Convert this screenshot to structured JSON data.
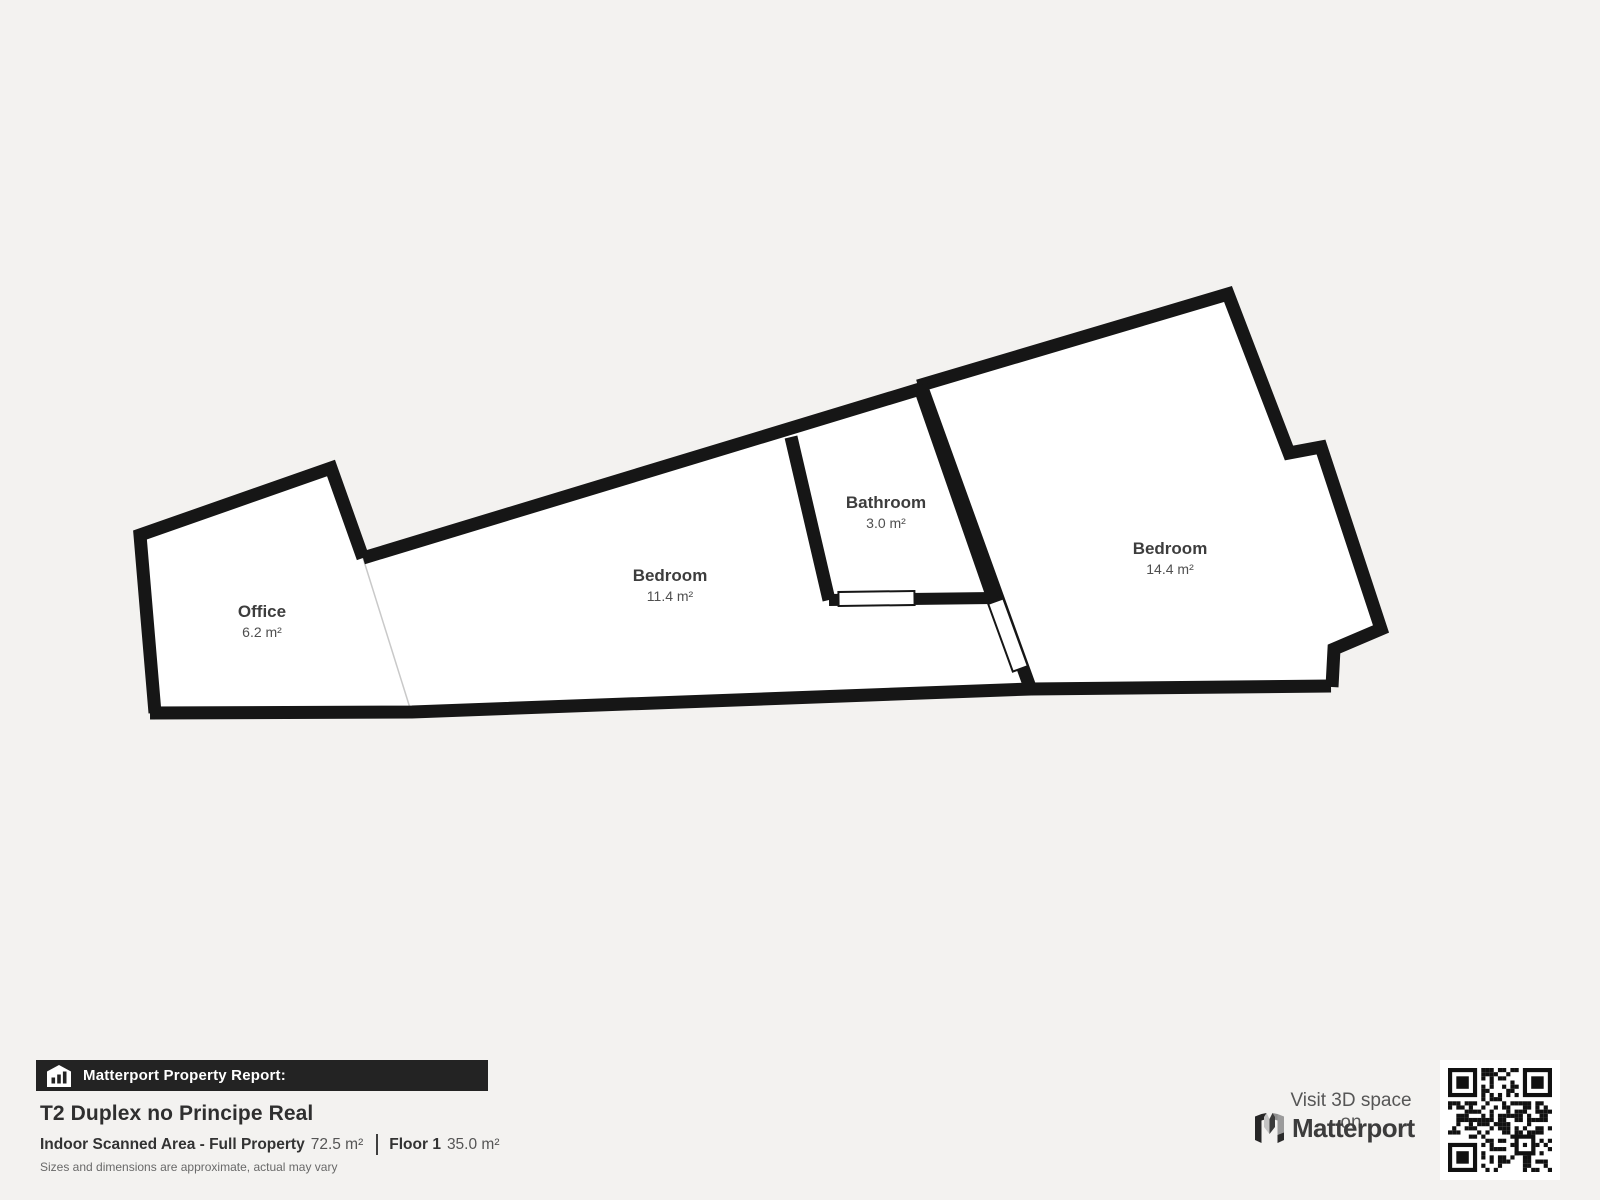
{
  "plan": {
    "rooms": [
      {
        "name": "Office",
        "area": "6.2 m²"
      },
      {
        "name": "Bedroom",
        "area": "11.4 m²"
      },
      {
        "name": "Bathroom",
        "area": "3.0 m²"
      },
      {
        "name": "Bedroom",
        "area": "14.4 m²"
      }
    ]
  },
  "report": {
    "banner": "Matterport Property Report:",
    "title": "T2 Duplex no Principe Real",
    "scanned_area_label": "Indoor Scanned Area - Full Property",
    "scanned_area_value": "72.5 m²",
    "floor_label": "Floor 1",
    "floor_value": "35.0 m²",
    "disclaimer": "Sizes and dimensions are approximate, actual may vary"
  },
  "promo": {
    "visit_label": "Visit 3D space on",
    "brand": "Matterport"
  },
  "colors": {
    "bg": "#f3f2f0",
    "wall": "#161616",
    "floor": "#ffffff",
    "banner": "#232323"
  }
}
